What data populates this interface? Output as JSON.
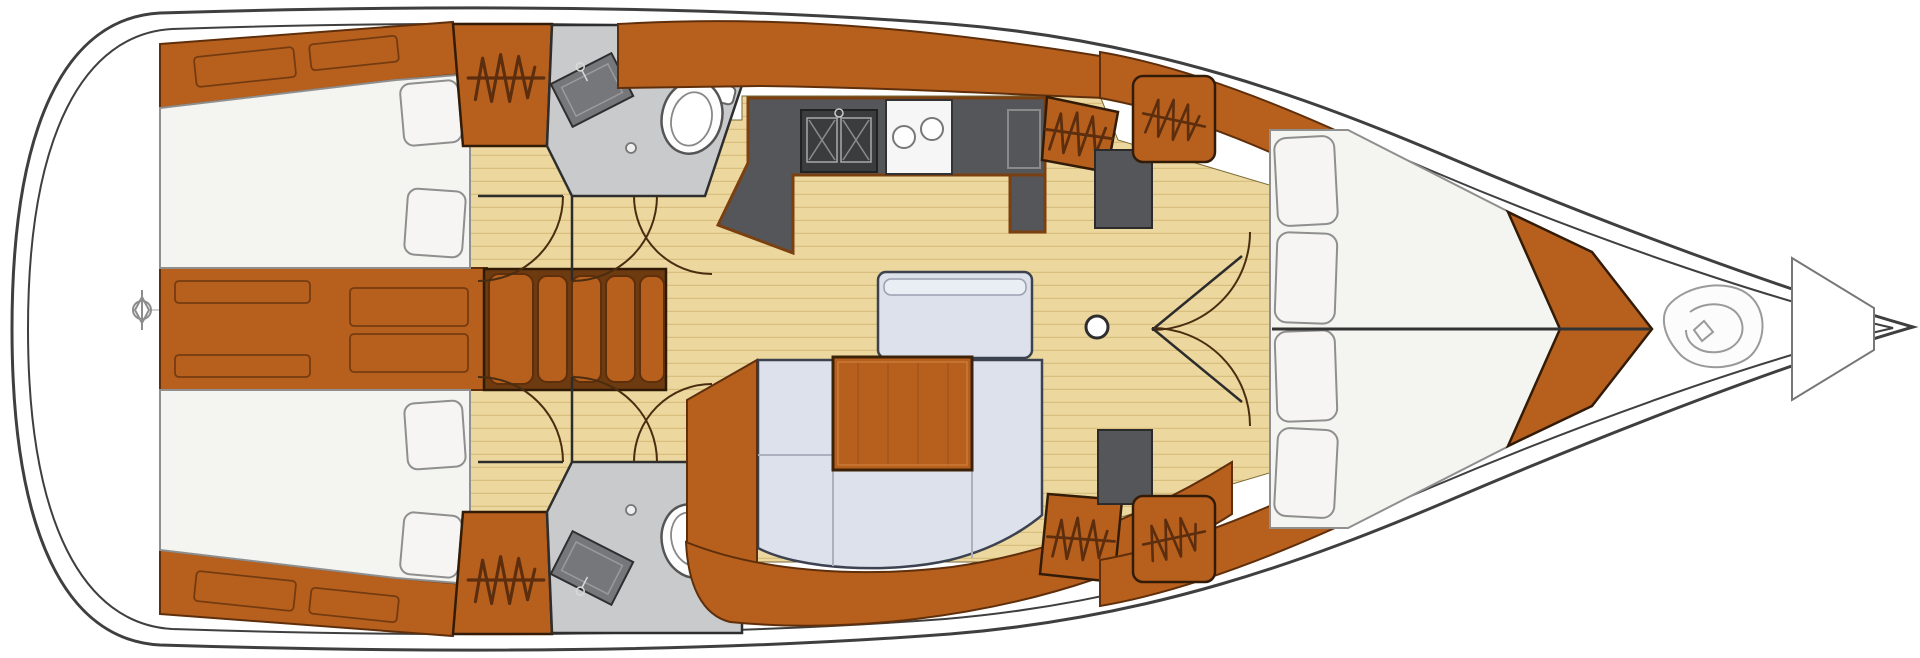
{
  "diagram": {
    "type": "sailboat-interior-floor-plan",
    "orientation": "bow-right"
  },
  "palette": {
    "hull": "#ffffff",
    "line": "#3f3f3f",
    "wood": "#b7601e",
    "wood_edge": "#5f2f0c",
    "wood_dark": "#6e3a10",
    "floor": "#ecd79e",
    "plank": "#d8bf7e",
    "head_floor": "#c9cacc",
    "counter": "#55565a",
    "counter_dark": "#3b3c3e",
    "counter_edge": "#7a4012",
    "cushion": "#dce1eb",
    "cushion_edge": "#3c4250",
    "cushion_seam": "#aab0bd",
    "bed": "#f4f4f1",
    "pillow": "#f6f5f3",
    "bed_edge": "#8f8f8f",
    "zigzag": "#5c2e0e",
    "door_arc": "#4a2d10",
    "stove": "#f6f6f6",
    "metal": "#8d8d8d",
    "rope": "#9a9a9a"
  },
  "symbols": {
    "zigzag": "hanging-locker",
    "coil": "anchor-rope",
    "post": "mast-post",
    "crossed_circle": "windlass-fitting",
    "double_square": "galley-double-sink",
    "two_circles": "two-burner-stove",
    "oval": "marine-toilet"
  }
}
